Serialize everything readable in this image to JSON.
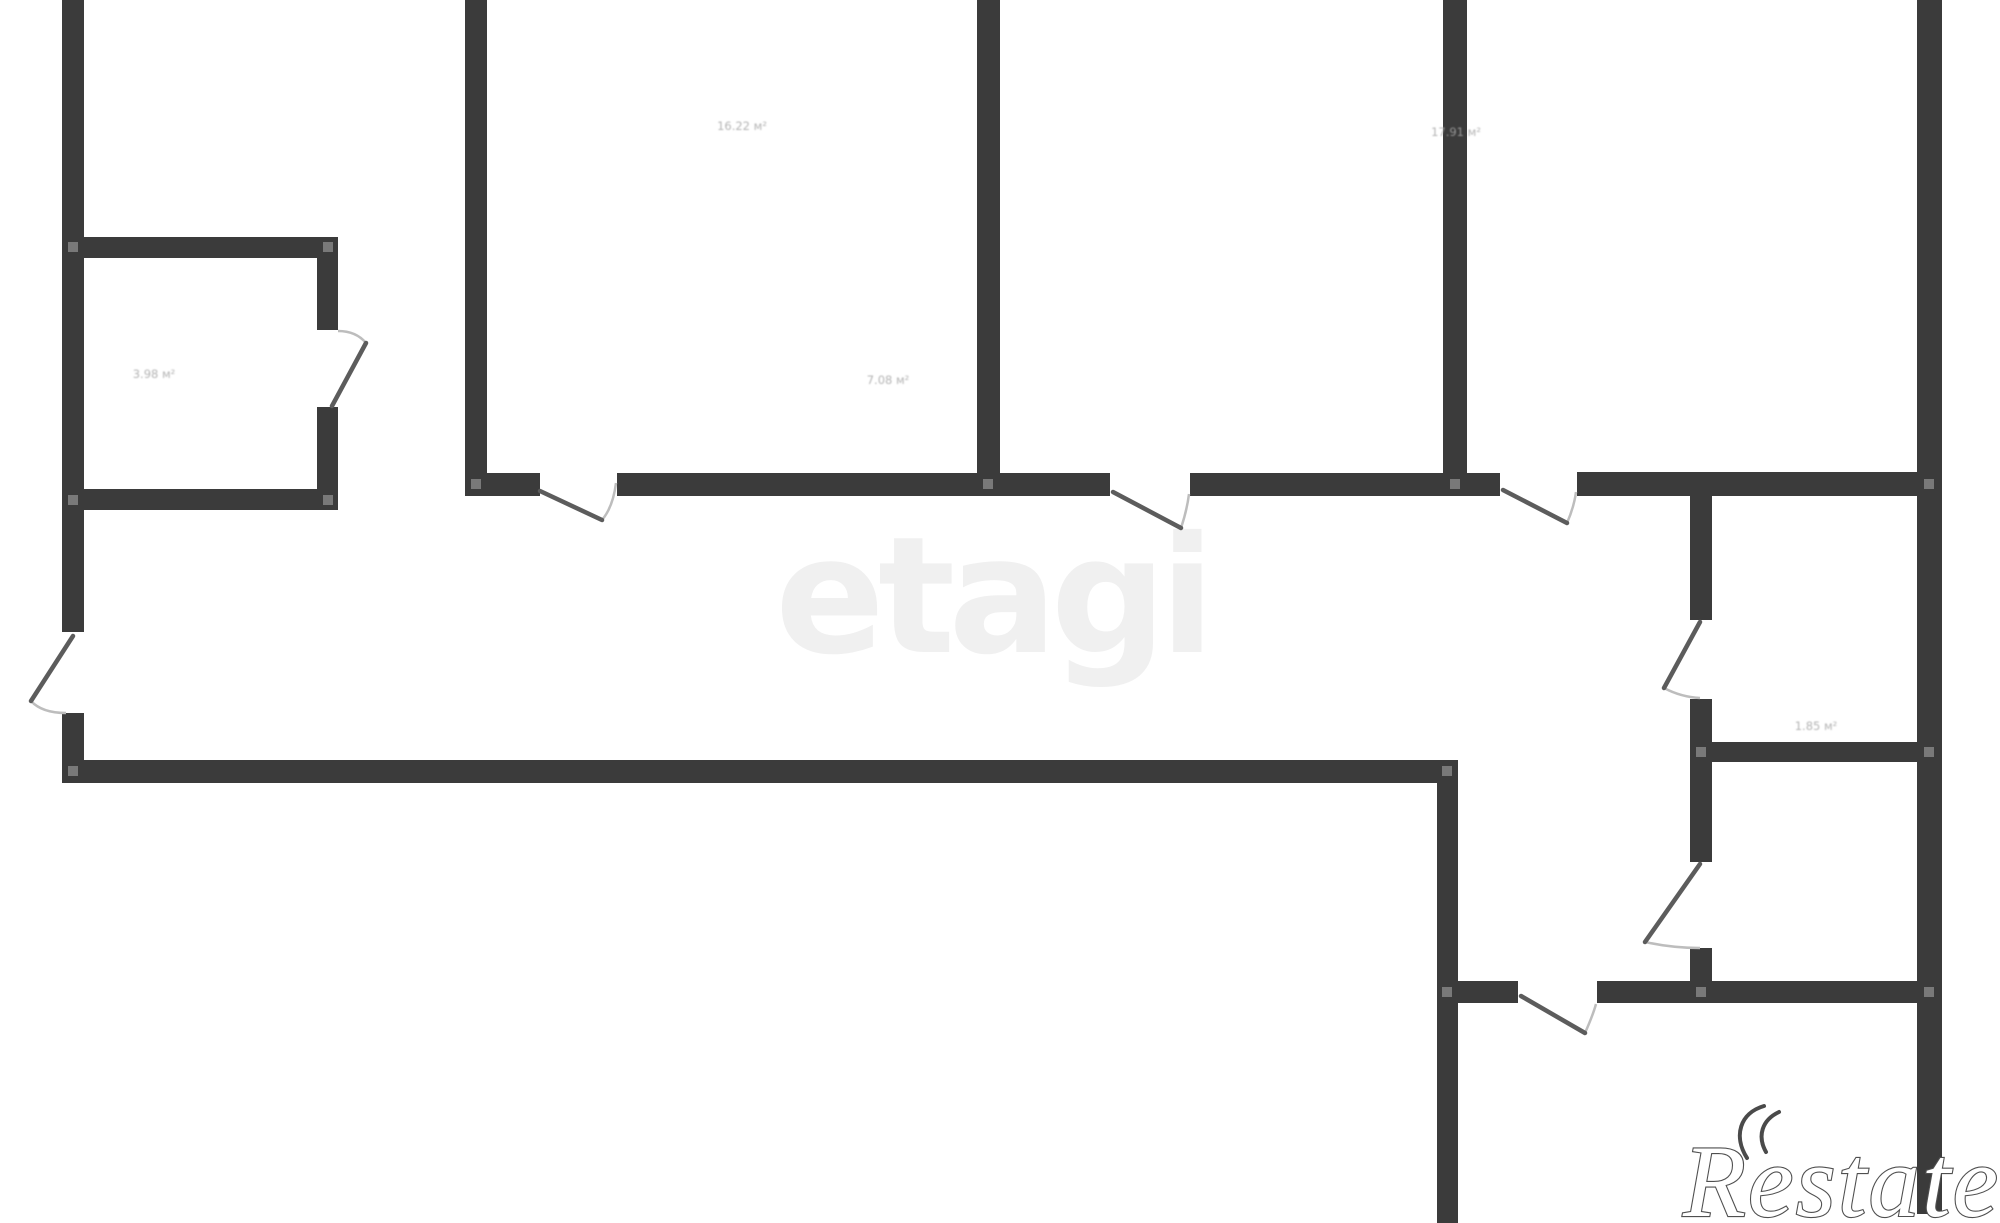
{
  "page": {
    "width": 2000,
    "height": 1223,
    "background": "#ffffff"
  },
  "palette": {
    "wall": "#3b3b3b",
    "door_leaf": "#5c5c5c",
    "door_arc": "#bdbdbd",
    "joint": "#8f8f8f",
    "label_text": "#a6a6a6"
  },
  "watermarks": {
    "etagi": {
      "text": "etagi",
      "color": "#f0f0f0",
      "x": 775,
      "baseline_y": 652,
      "font_size": 162
    },
    "restate": {
      "text": "Restate",
      "stroke_color": "#4f4f4f",
      "fill_color": "#ffffff",
      "x": 1683,
      "baseline_y": 1216,
      "font_size": 103,
      "logo": {
        "name": "double-crescent-mark",
        "color": "#4a4a4a",
        "paths": [
          "M 1747 1158 C 1733 1136, 1740 1113, 1764 1106",
          "M 1766 1152 C 1757 1136, 1762 1120, 1779 1112"
        ]
      }
    }
  },
  "floorplan": {
    "walls": [
      {
        "x": 62,
        "y": 0,
        "w": 22,
        "h": 632
      },
      {
        "x": 62,
        "y": 713,
        "w": 22,
        "h": 70
      },
      {
        "x": 62,
        "y": 760,
        "w": 1396,
        "h": 23
      },
      {
        "x": 1437,
        "y": 760,
        "w": 21,
        "h": 463
      },
      {
        "x": 84,
        "y": 237,
        "w": 254,
        "h": 21
      },
      {
        "x": 317,
        "y": 237,
        "w": 21,
        "h": 93
      },
      {
        "x": 317,
        "y": 407,
        "w": 21,
        "h": 103
      },
      {
        "x": 84,
        "y": 489,
        "w": 254,
        "h": 21
      },
      {
        "x": 465,
        "y": 0,
        "w": 22,
        "h": 493
      },
      {
        "x": 465,
        "y": 473,
        "w": 75,
        "h": 23
      },
      {
        "x": 617,
        "y": 473,
        "w": 493,
        "h": 23
      },
      {
        "x": 977,
        "y": 0,
        "w": 23,
        "h": 473
      },
      {
        "x": 1190,
        "y": 473,
        "w": 310,
        "h": 23
      },
      {
        "x": 1443,
        "y": 0,
        "w": 24,
        "h": 473
      },
      {
        "x": 1577,
        "y": 472,
        "w": 340,
        "h": 24
      },
      {
        "x": 1917,
        "y": 0,
        "w": 25,
        "h": 1214
      },
      {
        "x": 1690,
        "y": 496,
        "w": 22,
        "h": 124
      },
      {
        "x": 1690,
        "y": 699,
        "w": 22,
        "h": 163
      },
      {
        "x": 1712,
        "y": 742,
        "w": 205,
        "h": 20
      },
      {
        "x": 1690,
        "y": 948,
        "w": 22,
        "h": 55
      },
      {
        "x": 1458,
        "y": 981,
        "w": 60,
        "h": 22
      },
      {
        "x": 1597,
        "y": 981,
        "w": 320,
        "h": 22
      }
    ],
    "joints": [
      [
        73,
        247
      ],
      [
        328,
        247
      ],
      [
        73,
        500
      ],
      [
        328,
        500
      ],
      [
        476,
        484
      ],
      [
        988,
        484
      ],
      [
        1455,
        484
      ],
      [
        1929,
        484
      ],
      [
        1701,
        752
      ],
      [
        1929,
        752
      ],
      [
        73,
        771
      ],
      [
        1447,
        771
      ],
      [
        1447,
        992
      ],
      [
        1701,
        992
      ],
      [
        1929,
        992
      ]
    ],
    "doors": [
      {
        "leaf": [
          73,
          636,
          31,
          701
        ],
        "arc": "M 31 701 Q 42 713 66 713"
      },
      {
        "leaf": [
          332,
          406,
          366,
          343
        ],
        "arc": "M 366 343 Q 356 331 338 331"
      },
      {
        "leaf": [
          540,
          491,
          602,
          520
        ],
        "arc": "M 602 520 Q 613 507 616 483"
      },
      {
        "leaf": [
          1113,
          492,
          1181,
          528
        ],
        "arc": "M 1181 528 Q 1187 510 1189 494"
      },
      {
        "leaf": [
          1503,
          490,
          1567,
          523
        ],
        "arc": "M 1567 523 Q 1574 507 1576 492"
      },
      {
        "leaf": [
          1700,
          622,
          1664,
          688
        ],
        "arc": "M 1664 688 Q 1681 697 1700 698"
      },
      {
        "leaf": [
          1700,
          864,
          1645,
          942
        ],
        "arc": "M 1645 942 Q 1672 948 1700 948"
      },
      {
        "leaf": [
          1521,
          996,
          1585,
          1033
        ],
        "arc": "M 1585 1033 Q 1593 1015 1596 1004"
      }
    ],
    "room_labels": [
      {
        "text": "16.22 м²",
        "x": 742,
        "y": 130
      },
      {
        "text": "7.08 м²",
        "x": 888,
        "y": 384
      },
      {
        "text": "3.98 м²",
        "x": 154,
        "y": 378
      },
      {
        "text": "17.91 м²",
        "x": 1456,
        "y": 136
      },
      {
        "text": "1.85 м²",
        "x": 1816,
        "y": 730
      }
    ]
  }
}
